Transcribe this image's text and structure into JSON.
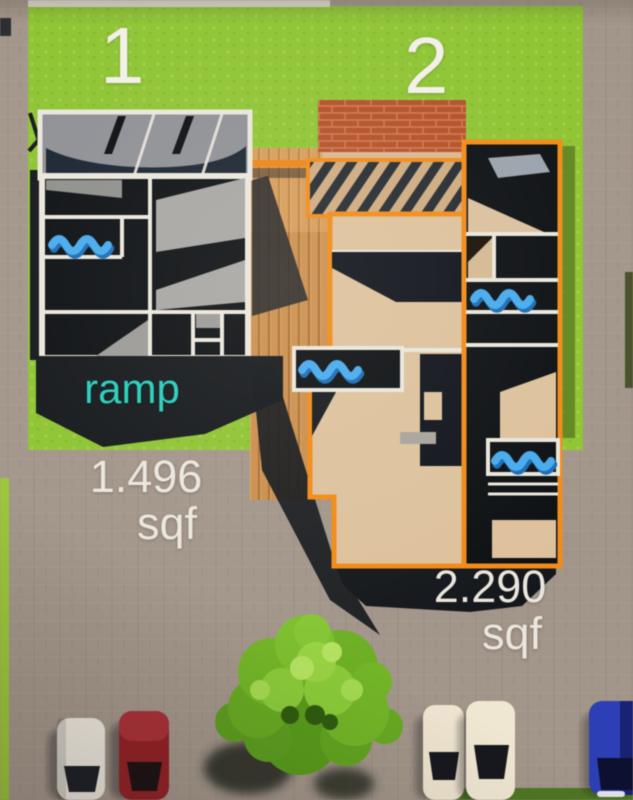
{
  "scene": {
    "description": "Top-down 3D rendered site plan showing two residential units with floor plans, a shared wood deck, lawn, street parking and a tree"
  },
  "units": {
    "unit1": {
      "number": "1",
      "area_value": "1.496",
      "area_unit": "sqf",
      "ramp_label": "ramp"
    },
    "unit2": {
      "number": "2",
      "area_value": "2.290",
      "area_unit": "sqf"
    }
  },
  "environment": {
    "cars": [
      "white",
      "red",
      "cream",
      "cream",
      "blue"
    ],
    "tree_count": 1
  },
  "colors": {
    "grass": "#8fc337",
    "pavement": "#a2958a",
    "wall-white": "#eae6db",
    "floor-dark": "#0d1013",
    "unit2-wall-orange": "#ee8b1c",
    "floor-beige": "#dcc19e",
    "roof-brick": "#b0502a",
    "deck-wood": "#c98e4e",
    "water-blue": "#4aa9ea",
    "water-blue-dark": "#1e6cb2",
    "ramp-text-teal": "#2accbb",
    "label-white": "#f3f0e9"
  }
}
